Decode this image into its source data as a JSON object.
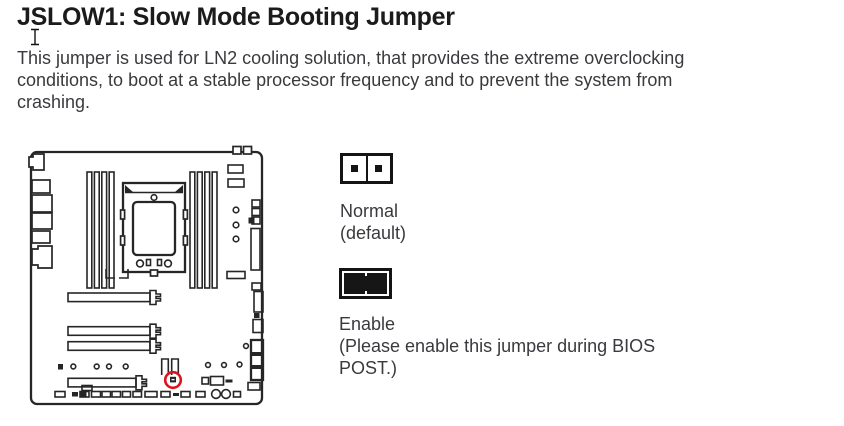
{
  "header": {
    "title": "JSLOW1: Slow Mode Booting Jumper",
    "description_lines": [
      "This jumper is used for LN2 cooling solution, that provides the extreme overclocking",
      "conditions, to boot at a stable processor frequency and to prevent the system from",
      "crashing."
    ]
  },
  "jumper_states": {
    "normal": {
      "label": "Normal",
      "note": "(default)"
    },
    "enable": {
      "label": "Enable",
      "note_line1": "(Please enable this jumper during BIOS",
      "note_line2": "POST.)"
    }
  },
  "diagram": {
    "name": "motherboard-jslow1-location-diagram",
    "highlight_color": "#e0131c"
  }
}
